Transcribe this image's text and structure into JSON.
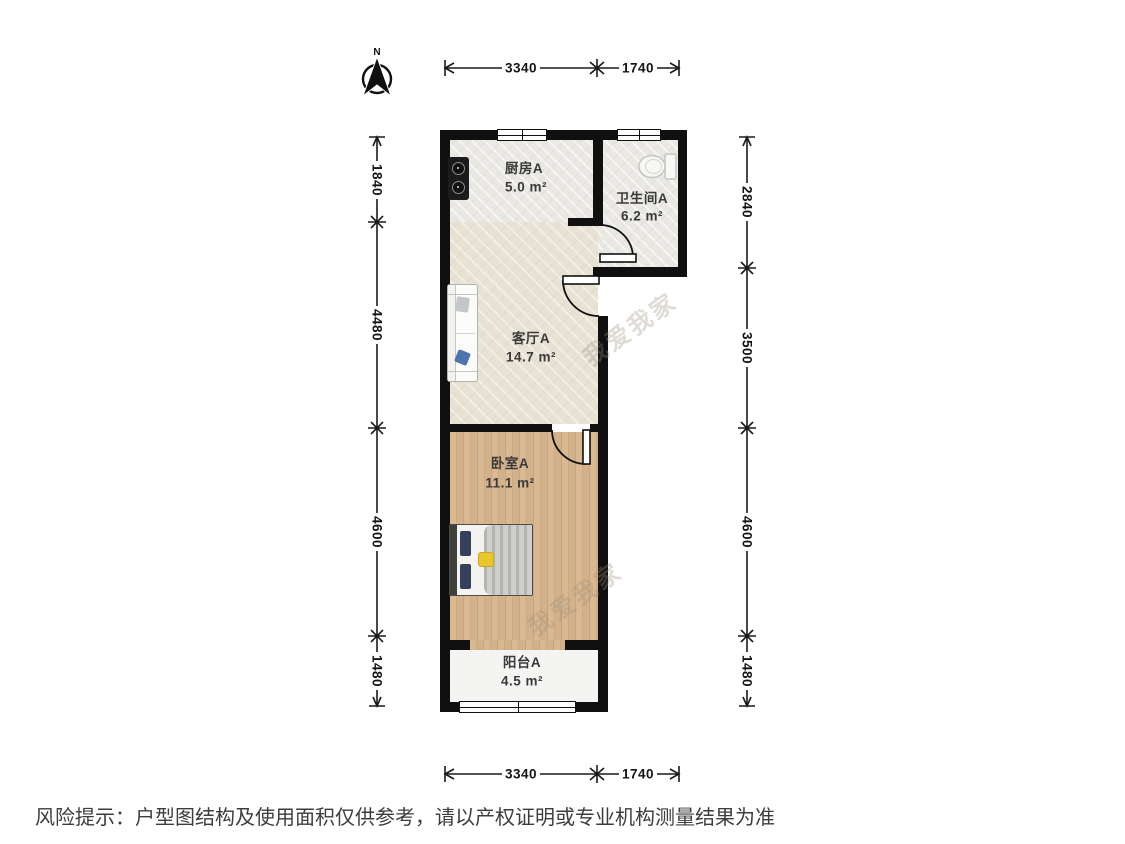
{
  "north": {
    "label": "N"
  },
  "dimensions": {
    "top": [
      "3340",
      "1740"
    ],
    "bottom": [
      "3340",
      "1740"
    ],
    "left": [
      "1840",
      "4480",
      "4600",
      "1480"
    ],
    "right": [
      "2840",
      "3500",
      "4600",
      "1480"
    ]
  },
  "rooms": {
    "kitchen": {
      "name": "厨房A",
      "area": "5.0 m²"
    },
    "bathroom": {
      "name": "卫生间A",
      "area": "6.2 m²"
    },
    "living": {
      "name": "客厅A",
      "area": "14.7 m²"
    },
    "bedroom": {
      "name": "卧室A",
      "area": "11.1 m²"
    },
    "balcony": {
      "name": "阳台A",
      "area": "4.5 m²"
    }
  },
  "watermark": {
    "text": "我爱我家"
  },
  "disclaimer": {
    "text": "风险提示：户型图结构及使用面积仅供参考，请以产权证明或专业机构测量结果为准"
  },
  "colors": {
    "wall": "#101010",
    "tile_floor": "#eae8e3",
    "living_floor": "#e8e2d4",
    "wood_floor": "#d6b590",
    "balcony_floor": "#f4f4f2",
    "pillow_blue": "#4e74ad",
    "pillow_yellow": "#e7c62e"
  }
}
